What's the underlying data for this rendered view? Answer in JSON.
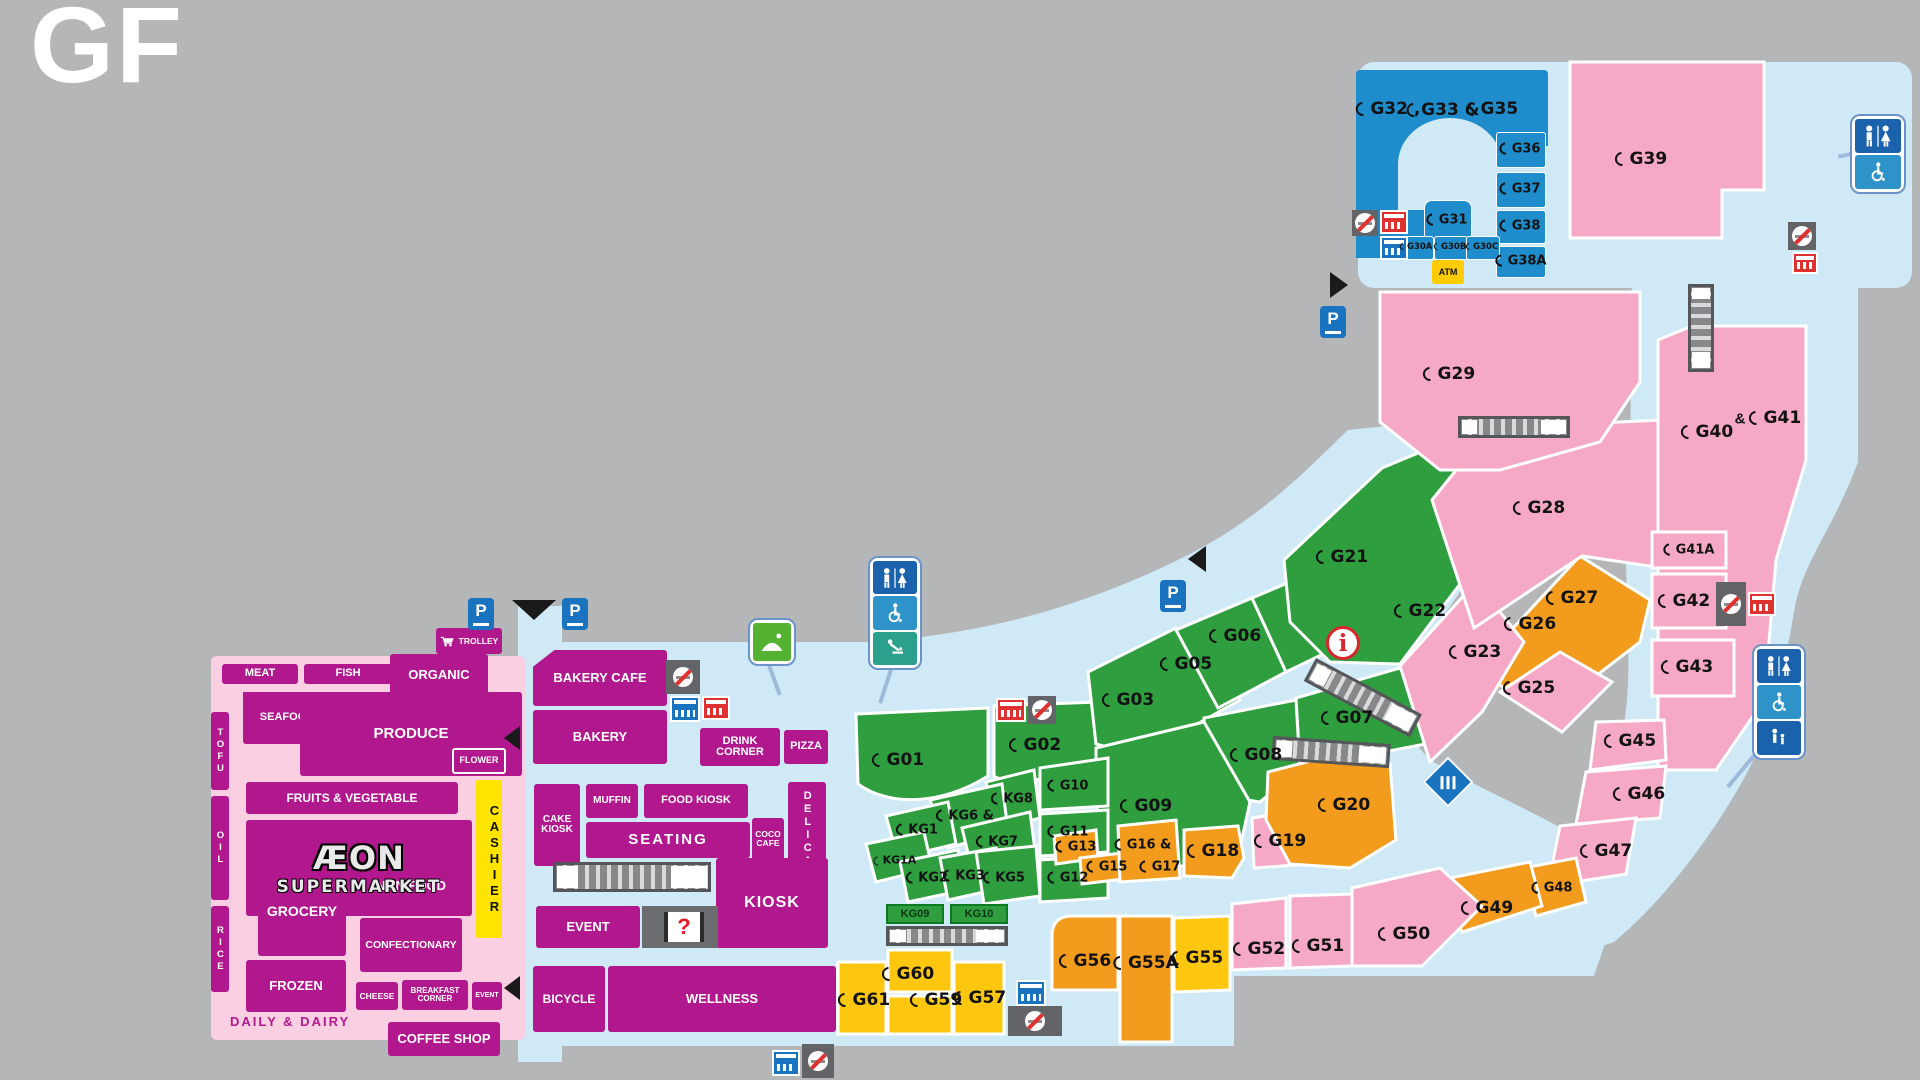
{
  "floor_label": "GF",
  "colors": {
    "magenta": "#b1188e",
    "pink": "#f6a9c7",
    "green": "#2f9e3f",
    "orange": "#f29b1d",
    "yellow": "#fdc70f",
    "blue": "#1f8ccc",
    "walkway": "#cfe9f6",
    "background": "#b4b6b8"
  },
  "supermarket": {
    "brand_top": "ÆON",
    "brand_bottom": "SUPERMARKET",
    "meat": "MEAT",
    "fish": "FISH",
    "seafood": "SEAFOOD",
    "produce": "PRODUCE",
    "organic": "ORGANIC",
    "trolley": "TROLLEY",
    "flower": "FLOWER",
    "fruits_vegetable": "FRUITS & VEGETABLE",
    "cashier": "CASHIER",
    "tofu": "TOFU",
    "oil": "OIL",
    "rice": "RICE",
    "grocery": "GROCERY",
    "non_food": "NON FOOD",
    "confectionary": "CONFECTIONARY",
    "frozen": "FROZEN",
    "cheese": "CHEESE",
    "breakfast_corner": "BREAKFAST CORNER",
    "event": "EVENT",
    "daily_dairy": "DAILY & DAIRY",
    "coffee_shop": "COFFEE SHOP"
  },
  "center": {
    "bakery_cafe": "BAKERY CAFE",
    "bakery": "BAKERY",
    "drink_corner": "DRINK CORNER",
    "pizza": "PIZZA",
    "cake_kiosk": "CAKE KIOSK",
    "muffin": "MUFFIN",
    "food_kiosk": "FOOD KIOSK",
    "seating": "SEATING",
    "coco_cafe": "COCO CAFE",
    "delica": "DELICA",
    "sushi": "SUSHI",
    "kiosk": "KIOSK",
    "event": "EVENT",
    "question": "?",
    "bicycle": "BICYCLE",
    "wellness": "WELLNESS"
  },
  "units": {
    "g01": "G01",
    "g02": "G02",
    "g03": "G03",
    "g05": "G05",
    "g06": "G06",
    "g07": "G07",
    "g08": "G08",
    "g09": "G09",
    "g10": "G10",
    "g11": "G11",
    "g12": "G12",
    "g13": "G13",
    "g15": "G15",
    "g16": "G16 &",
    "g17": "G17",
    "g18": "G18",
    "g19": "G19",
    "g20": "G20",
    "g21": "G21",
    "g22": "G22",
    "g23": "G23",
    "g25": "G25",
    "g26": "G26",
    "g27": "G27",
    "g28": "G28",
    "g29": "G29",
    "g30a": "G30A",
    "g30b": "G30B",
    "g30c": "G30C",
    "g31": "G31",
    "g32": "G32 ,",
    "g33": "G33 &",
    "g35": "G35",
    "g36": "G36",
    "g37": "G37",
    "g38": "G38",
    "g38a": "G38A",
    "g39": "G39",
    "g40": "G40",
    "g40_amp": "&",
    "g41": "G41",
    "g41a": "G41A",
    "g42": "G42",
    "g43": "G43",
    "g45": "G45",
    "g46": "G46",
    "g47": "G47",
    "g48": "G48",
    "g49": "G49",
    "g50": "G50",
    "g51": "G51",
    "g52": "G52",
    "g55": "G55",
    "g55a": "G55A",
    "g56": "G56",
    "g57": "G57",
    "g59": "G59",
    "g60": "G60",
    "g61": "G61",
    "kg1": "KG1",
    "kg1a": "KG1A",
    "kg2": "KG2",
    "kg3": "KG3",
    "kg5": "KG5",
    "kg6": "KG6 &",
    "kg7": "KG7",
    "kg8": "KG8",
    "kg09": "KG09",
    "kg10": "KG10",
    "atm": "ATM"
  },
  "icons": {
    "parking": "P",
    "info": "i"
  }
}
